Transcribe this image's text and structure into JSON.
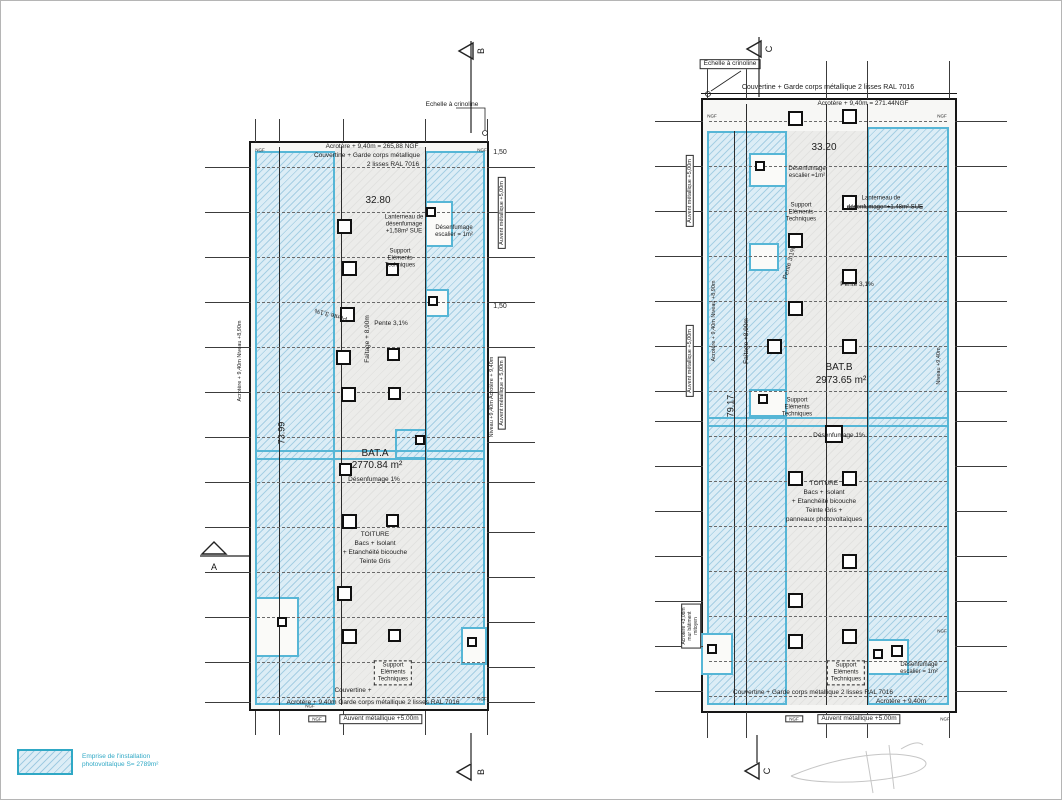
{
  "legend": {
    "line1": "Emprise de l'installation",
    "line2": "photovoltaïque S= 2789m²"
  },
  "colors": {
    "pv_fill": "#dcedf6",
    "pv_border": "#56b6d6",
    "legend_text": "#2fa8c5",
    "ink": "#1c1c1c"
  },
  "buildings": [
    {
      "id": "bat-a",
      "frame": {
        "x": 248,
        "y": 140,
        "w": 240,
        "h": 570
      },
      "graystrip": {
        "x": 334,
        "y": 146,
        "w": 90,
        "h": 558
      },
      "zones": [
        {
          "x": 254,
          "y": 150,
          "w": 80,
          "h": 554
        },
        {
          "x": 424,
          "y": 150,
          "w": 60,
          "h": 554
        },
        {
          "x": 394,
          "y": 428,
          "w": 32,
          "h": 30
        }
      ],
      "bands": [
        {
          "x": 254,
          "y": 449,
          "w": 230,
          "h": 10
        }
      ],
      "notches": [
        {
          "x": 424,
          "y": 200,
          "w": 28,
          "h": 46
        },
        {
          "x": 424,
          "y": 288,
          "w": 24,
          "h": 28
        },
        {
          "x": 460,
          "y": 626,
          "w": 26,
          "h": 38
        },
        {
          "x": 254,
          "y": 596,
          "w": 44,
          "h": 60
        }
      ],
      "vlines": [
        {
          "x": 340,
          "y": 146,
          "h": 558
        },
        {
          "x": 424,
          "y": 146,
          "h": 558
        },
        {
          "x": 278,
          "y": 146,
          "h": 558
        }
      ],
      "hlines": [],
      "dashrows": {
        "x": 256,
        "w": 228,
        "ys": [
          166,
          211,
          256,
          301,
          346,
          391,
          436,
          481,
          526,
          571,
          616,
          661,
          696
        ]
      },
      "squares": [
        [
          336,
          218,
          15
        ],
        [
          341,
          260,
          15
        ],
        [
          339,
          306,
          15
        ],
        [
          335,
          349,
          15
        ],
        [
          340,
          386,
          15
        ],
        [
          338,
          462,
          13
        ],
        [
          341,
          513,
          15
        ],
        [
          336,
          585,
          15
        ],
        [
          341,
          628,
          15
        ],
        [
          385,
          262,
          13
        ],
        [
          386,
          347,
          13
        ],
        [
          387,
          386,
          13
        ],
        [
          385,
          513,
          13
        ],
        [
          387,
          628,
          13
        ],
        [
          425,
          206,
          10
        ],
        [
          427,
          295,
          10
        ],
        [
          414,
          434,
          10
        ],
        [
          466,
          636,
          10
        ],
        [
          276,
          616,
          10
        ]
      ],
      "ticks": {
        "h": [
          {
            "x": 204,
            "w": 46,
            "ys": [
              166,
              211,
              256,
              301,
              346,
              391,
              436,
              481,
              526,
              571,
              616,
              661,
              701
            ]
          },
          {
            "x": 486,
            "w": 48,
            "ys": [
              166,
              211,
              256,
              301,
              346,
              391,
              441,
              481,
              531,
              576,
              621,
              666,
              701
            ]
          }
        ],
        "v": [
          {
            "y": 118,
            "h": 23,
            "xs": [
              254,
              278,
              342,
              424,
              486
            ]
          },
          {
            "y": 710,
            "h": 24,
            "xs": [
              254,
              278,
              342,
              424,
              486
            ]
          }
        ]
      },
      "annotations": [
        {
          "t": "Echelle à crinoline",
          "x": 451,
          "y": 104,
          "s": 6.5
        },
        {
          "t": "Acrotère + 9,40m = 265,88 NGF",
          "x": 371,
          "y": 146,
          "s": 6.5
        },
        {
          "t": "Couvertine + Garde corps métallique",
          "x": 366,
          "y": 155,
          "s": 6.5
        },
        {
          "t": "2 lisses RAL 7016",
          "x": 392,
          "y": 164,
          "s": 6.5
        },
        {
          "t": "32.80",
          "x": 377,
          "y": 200,
          "s": 10
        },
        {
          "t": "Lanterneau de\ndésenfumage\n+1,58m² SUE",
          "x": 403,
          "y": 224,
          "s": 6,
          "pre": 1
        },
        {
          "t": "Désenfumage\nescalier = 1m²",
          "x": 453,
          "y": 231,
          "s": 6,
          "pre": 1
        },
        {
          "t": "Support\nEléments\nTechniques",
          "x": 399,
          "y": 258,
          "s": 6,
          "pre": 1
        },
        {
          "t": "Pente 3,1%",
          "x": 330,
          "y": 313,
          "s": 6.5,
          "r": -165
        },
        {
          "t": "Pente 3,1%",
          "x": 390,
          "y": 323,
          "s": 6.5
        },
        {
          "t": "Faîtage + 8,90m",
          "x": 367,
          "y": 338,
          "s": 6.5,
          "r": -90
        },
        {
          "t": "BAT.A",
          "x": 374,
          "y": 453,
          "s": 10
        },
        {
          "t": "2770.84 m²",
          "x": 376,
          "y": 465,
          "s": 10
        },
        {
          "t": "Désenfumage 1%",
          "x": 373,
          "y": 479,
          "s": 6.5
        },
        {
          "t": "TOITURE",
          "x": 374,
          "y": 534,
          "s": 6.5
        },
        {
          "t": "Bacs + Isolant",
          "x": 374,
          "y": 543,
          "s": 6.5
        },
        {
          "t": "+ Etanchéité bicouche",
          "x": 374,
          "y": 552,
          "s": 6.5
        },
        {
          "t": "Teinte Gris",
          "x": 374,
          "y": 561,
          "s": 6.5
        },
        {
          "t": "Support\nEléments\nTechniques",
          "x": 392,
          "y": 672,
          "s": 6,
          "pre": 1,
          "dash": 1
        },
        {
          "t": "Couvertine +",
          "x": 352,
          "y": 690,
          "s": 6.5
        },
        {
          "t": "Acrotère + 9,40m Garde corps métallique 2 lisses RAL 7016",
          "x": 372,
          "y": 702,
          "s": 6.5
        },
        {
          "t": "Auvent métallique +5.00m",
          "x": 380,
          "y": 718,
          "s": 6.5,
          "box": 1
        },
        {
          "t": "NGF",
          "x": 316,
          "y": 718,
          "s": 4.5,
          "box": 1
        },
        {
          "t": "Acrotère + 9,40m    Niveau +8,90m",
          "x": 239,
          "y": 360,
          "s": 5.5,
          "r": -90
        },
        {
          "t": "73.99",
          "x": 281,
          "y": 432,
          "s": 9,
          "r": -90
        },
        {
          "t": "1,50",
          "x": 499,
          "y": 152,
          "s": 7
        },
        {
          "t": "Auvent métallique +5,00m",
          "x": 501,
          "y": 212,
          "s": 5.5,
          "r": -90,
          "box": 1
        },
        {
          "t": "1,50",
          "x": 499,
          "y": 306,
          "s": 7
        },
        {
          "t": "Auvent métallique + 5,00m",
          "x": 501,
          "y": 392,
          "s": 5.5,
          "r": -90,
          "box": 1
        },
        {
          "t": "Niveau +9,40m    Acrotère + 9,40m",
          "x": 491,
          "y": 396,
          "s": 5.5,
          "r": -90
        },
        {
          "t": "NGF",
          "x": 259,
          "y": 149,
          "s": 4.5
        },
        {
          "t": "NGF",
          "x": 481,
          "y": 149,
          "s": 4.5
        },
        {
          "t": "NGF",
          "x": 481,
          "y": 698,
          "s": 4.5
        },
        {
          "t": "NGF",
          "x": 309,
          "y": 705,
          "s": 4.5
        }
      ]
    },
    {
      "id": "bat-b",
      "frame": {
        "x": 700,
        "y": 97,
        "w": 256,
        "h": 615
      },
      "graystrip": {
        "x": 786,
        "y": 130,
        "w": 80,
        "h": 574
      },
      "zones": [
        {
          "x": 706,
          "y": 130,
          "w": 80,
          "h": 574
        },
        {
          "x": 866,
          "y": 126,
          "w": 82,
          "h": 578
        }
      ],
      "bands": [
        {
          "x": 706,
          "y": 416,
          "w": 242,
          "h": 10
        }
      ],
      "notches": [
        {
          "x": 748,
          "y": 152,
          "w": 38,
          "h": 34
        },
        {
          "x": 748,
          "y": 242,
          "w": 30,
          "h": 28
        },
        {
          "x": 748,
          "y": 388,
          "w": 38,
          "h": 28
        },
        {
          "x": 700,
          "y": 632,
          "w": 32,
          "h": 42
        },
        {
          "x": 866,
          "y": 638,
          "w": 42,
          "h": 36
        }
      ],
      "vlines": [
        {
          "x": 745,
          "y": 103,
          "h": 601
        },
        {
          "x": 825,
          "y": 103,
          "h": 601
        },
        {
          "x": 866,
          "y": 103,
          "h": 601
        },
        {
          "x": 733,
          "y": 130,
          "h": 574
        }
      ],
      "hlines": [
        {
          "x": 700,
          "y": 92,
          "w": 256
        }
      ],
      "dashrows": {
        "x": 708,
        "w": 238,
        "ys": [
          120,
          165,
          210,
          255,
          300,
          345,
          390,
          435,
          480,
          525,
          570,
          615,
          660,
          695
        ]
      },
      "squares": [
        [
          787,
          110,
          15
        ],
        [
          841,
          108,
          15
        ],
        [
          754,
          160,
          10
        ],
        [
          841,
          194,
          15
        ],
        [
          787,
          232,
          15
        ],
        [
          841,
          268,
          15
        ],
        [
          787,
          300,
          15
        ],
        [
          766,
          338,
          15
        ],
        [
          841,
          338,
          15
        ],
        [
          757,
          393,
          10
        ],
        [
          824,
          424,
          18
        ],
        [
          787,
          470,
          15
        ],
        [
          841,
          470,
          15
        ],
        [
          841,
          553,
          15
        ],
        [
          787,
          592,
          15
        ],
        [
          706,
          643,
          10
        ],
        [
          787,
          633,
          15
        ],
        [
          841,
          628,
          15
        ],
        [
          872,
          648,
          10
        ],
        [
          890,
          644,
          12
        ]
      ],
      "ticks": {
        "h": [
          {
            "x": 654,
            "w": 48,
            "ys": [
              120,
              165,
              210,
              255,
              300,
              345,
              390,
              420,
              465,
              510,
              555,
              600,
              645,
              690
            ]
          },
          {
            "x": 954,
            "w": 52,
            "ys": [
              120,
              165,
              210,
              255,
              300,
              345,
              390,
              420,
              465,
              510,
              555,
              600,
              645,
              690
            ]
          }
        ],
        "v": [
          {
            "y": 60,
            "h": 38,
            "xs": [
              706,
              745,
              825,
              866,
              948
            ]
          },
          {
            "y": 711,
            "h": 26,
            "xs": [
              706,
              745,
              825,
              866,
              948
            ]
          }
        ]
      },
      "annotations": [
        {
          "t": "Echelle à crinoline",
          "x": 729,
          "y": 63,
          "s": 6.5,
          "box": 1
        },
        {
          "t": "Couvertine + Garde corps métallique 2 lisses RAL 7016",
          "x": 827,
          "y": 87,
          "s": 7
        },
        {
          "t": "Acrotère + 9,40m = 271.44NGF",
          "x": 862,
          "y": 103,
          "s": 6.5
        },
        {
          "t": "33.20",
          "x": 823,
          "y": 147,
          "s": 10
        },
        {
          "t": "Lanterneau de",
          "x": 880,
          "y": 198,
          "s": 6
        },
        {
          "t": "désenfumage=+1.48m² SUE",
          "x": 884,
          "y": 207,
          "s": 6,
          "strike": 1
        },
        {
          "t": "Désenfumage\nescalier =1m²",
          "x": 806,
          "y": 172,
          "s": 6,
          "pre": 1
        },
        {
          "t": "Support\nEléments\nTechniques",
          "x": 800,
          "y": 212,
          "s": 6,
          "pre": 1
        },
        {
          "t": "Pente 3,1%",
          "x": 789,
          "y": 262,
          "s": 6.5,
          "r": -75
        },
        {
          "t": "Pente 3,1%",
          "x": 856,
          "y": 284,
          "s": 6.5
        },
        {
          "t": "Faîtage +8,90m",
          "x": 746,
          "y": 340,
          "s": 6.5,
          "r": -90
        },
        {
          "t": "BAT.B",
          "x": 838,
          "y": 367,
          "s": 10
        },
        {
          "t": "2973.65 m²",
          "x": 840,
          "y": 380,
          "s": 10
        },
        {
          "t": "Support\nEléments\nTechniques",
          "x": 796,
          "y": 407,
          "s": 6,
          "pre": 1
        },
        {
          "t": "Désenfumage 1%",
          "x": 838,
          "y": 435,
          "s": 6.5
        },
        {
          "t": "TOITURE",
          "x": 823,
          "y": 483,
          "s": 6.5
        },
        {
          "t": "Bacs + Isolant",
          "x": 823,
          "y": 492,
          "s": 6.5
        },
        {
          "t": "+ Etanchéité bicouche",
          "x": 823,
          "y": 501,
          "s": 6.5
        },
        {
          "t": "Teinte Gris +",
          "x": 823,
          "y": 510,
          "s": 6.5
        },
        {
          "t": "panneaux photovoltaïques",
          "x": 823,
          "y": 519,
          "s": 6.5
        },
        {
          "t": "Support\nEléments\nTechniques",
          "x": 845,
          "y": 672,
          "s": 6,
          "pre": 1,
          "dash": 1
        },
        {
          "t": "Désenfumage\nescalier = 1m²",
          "x": 918,
          "y": 668,
          "s": 6,
          "pre": 1
        },
        {
          "t": "Couvertine + Garde corps métallique 2 lisses RAL 7016",
          "x": 812,
          "y": 692,
          "s": 6.5
        },
        {
          "t": "Acrotère + 9,40m",
          "x": 900,
          "y": 701,
          "s": 6.5
        },
        {
          "t": "Auvent métallique +5.00m",
          "x": 858,
          "y": 718,
          "s": 6.5,
          "box": 1
        },
        {
          "t": "NGF",
          "x": 793,
          "y": 718,
          "s": 4.5,
          "box": 1
        },
        {
          "t": "NGF",
          "x": 944,
          "y": 718,
          "s": 4.5
        },
        {
          "t": "Auvent métallique +5,00m",
          "x": 689,
          "y": 190,
          "s": 5.5,
          "r": -90,
          "box": 1
        },
        {
          "t": "Auvent métallique +5,00m",
          "x": 689,
          "y": 360,
          "s": 5.5,
          "r": -90,
          "box": 1
        },
        {
          "t": "Acrotère + 9,40m    Niveau +8,90m",
          "x": 713,
          "y": 320,
          "s": 5.5,
          "r": -90
        },
        {
          "t": "79.17",
          "x": 730,
          "y": 405,
          "s": 9,
          "r": -90
        },
        {
          "t": "Acrotère +3,08m\nmur bâtiment\nmitoyen",
          "x": 690,
          "y": 625,
          "s": 5,
          "r": -90,
          "pre": 1,
          "box": 1
        },
        {
          "t": "Niveau +9,40m",
          "x": 938,
          "y": 365,
          "s": 5.5,
          "r": -90
        },
        {
          "t": "NGF",
          "x": 711,
          "y": 115,
          "s": 4.5
        },
        {
          "t": "NGF",
          "x": 941,
          "y": 115,
          "s": 4.5
        },
        {
          "t": "NGF",
          "x": 941,
          "y": 630,
          "s": 4.5
        }
      ]
    }
  ],
  "markers": [
    {
      "label": "B",
      "tri": [
        [
          458,
          50
        ],
        [
          472,
          42
        ],
        [
          472,
          58
        ]
      ],
      "stem": [
        470,
        40,
        470,
        132
      ],
      "lx": 480,
      "ly": 50,
      "lr": -90
    },
    {
      "label": "B",
      "tri": [
        [
          456,
          771
        ],
        [
          470,
          763
        ],
        [
          470,
          779
        ]
      ],
      "stem": [
        470,
        732,
        470,
        762
      ],
      "lx": 480,
      "ly": 771,
      "lr": -90
    },
    {
      "label": "A",
      "tri": [
        [
          213,
          541
        ],
        [
          201,
          553
        ],
        [
          225,
          553
        ]
      ],
      "stem": [
        199,
        555,
        248,
        555
      ],
      "lx": 213,
      "ly": 566,
      "lr": 0
    },
    {
      "label": "C",
      "tri": [
        [
          746,
          48
        ],
        [
          760,
          40
        ],
        [
          760,
          56
        ]
      ],
      "stem": [
        758,
        36,
        758,
        96
      ],
      "lx": 768,
      "ly": 48,
      "lr": -90
    },
    {
      "label": "C",
      "tri": [
        [
          744,
          770
        ],
        [
          758,
          762
        ],
        [
          758,
          778
        ]
      ],
      "stem": [
        756,
        734,
        756,
        762
      ],
      "lx": 766,
      "ly": 770,
      "lr": -90
    }
  ],
  "leaders": [
    {
      "pts": [
        [
          455,
          107
        ],
        [
          484,
          107
        ],
        [
          484,
          129
        ]
      ],
      "dot": [
        484,
        132
      ]
    },
    {
      "pts": [
        [
          740,
          70
        ],
        [
          710,
          90
        ]
      ],
      "dot": [
        707,
        93
      ]
    }
  ],
  "signature": {
    "paths": [
      "M790,775 C830,758 882,748 915,756 C935,761 925,772 885,778 C850,783 805,782 790,775",
      "M865,750 L872,792",
      "M888,744 L893,788",
      "M900,748 C910,742 918,740 922,744"
    ]
  }
}
